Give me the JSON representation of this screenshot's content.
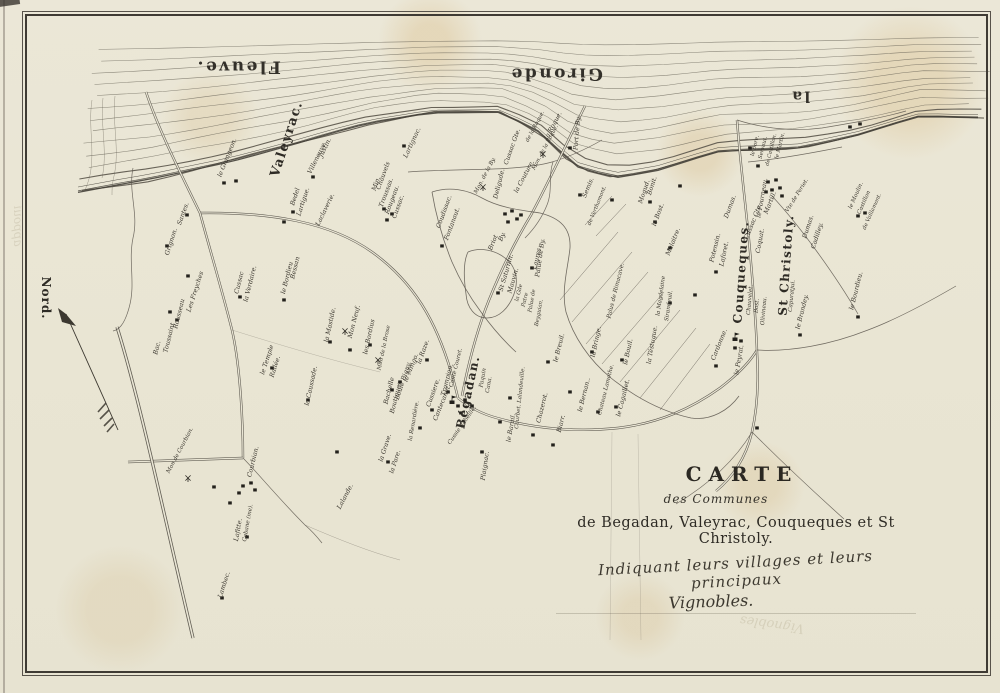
{
  "title_block": {
    "line1": "CARTE",
    "line2": "des Communes",
    "line3": "de Begadan, Valeyrac, Couqueques et St Christoly.",
    "line4": "Indiquant leurs villages et leurs principaux",
    "line5": "Vignobles."
  },
  "compass": {
    "label": "Nord."
  },
  "river_labels": [
    {
      "text": "Fleuve.",
      "x": 238,
      "y": 66,
      "size": 17
    },
    {
      "text": "Gironde",
      "x": 556,
      "y": 73,
      "size": 17
    },
    {
      "text": "la",
      "x": 800,
      "y": 96,
      "size": 15
    }
  ],
  "commune_labels": [
    {
      "text": "Valeyrac.",
      "x": 287,
      "y": 139,
      "r": -72,
      "size": 13
    },
    {
      "text": "Bégadan.",
      "x": 468,
      "y": 392,
      "r": -78,
      "size": 12
    },
    {
      "text": "Couqueques.",
      "x": 741,
      "y": 272,
      "r": -86,
      "size": 12
    },
    {
      "text": "St Christoly.",
      "x": 786,
      "y": 265,
      "r": -86,
      "size": 12
    }
  ],
  "place_labels": [
    [
      "le Grangeon.",
      228,
      158,
      -68
    ],
    [
      "Bedel",
      296,
      197,
      -72
    ],
    [
      "Lartigue.",
      304,
      202,
      -72
    ],
    [
      "Villeneuve.",
      318,
      158,
      -64
    ],
    [
      "Justin.",
      326,
      148,
      -64
    ],
    [
      "Laclaverie.",
      326,
      210,
      -64
    ],
    [
      "Min.",
      377,
      184,
      -70
    ],
    [
      "Chauvels",
      384,
      176,
      -70
    ],
    [
      "Troussas.",
      387,
      193,
      -70
    ],
    [
      "Rougeau.",
      393,
      200,
      -70
    ],
    [
      "Cussac.",
      399,
      207,
      -70
    ],
    [
      "Lartignac.",
      413,
      143,
      -65
    ],
    [
      "Santes.",
      184,
      214,
      -70
    ],
    [
      "Grignon.",
      172,
      242,
      -72
    ],
    [
      "Bac.",
      158,
      348,
      -76
    ],
    [
      "Toussaint",
      170,
      338,
      -76
    ],
    [
      "Rousseau",
      180,
      314,
      -76
    ],
    [
      "Les Freyches",
      196,
      292,
      -72
    ],
    [
      "Cussac",
      240,
      283,
      -76
    ],
    [
      "la Verdaire.",
      251,
      284,
      -76
    ],
    [
      "le Bordieu",
      288,
      278,
      -76
    ],
    [
      "Bessan",
      296,
      268,
      -76
    ],
    [
      "le Temple",
      268,
      360,
      -72
    ],
    [
      "Rallée.",
      276,
      367,
      -72
    ],
    [
      "la Caussade.",
      312,
      386,
      -78
    ],
    [
      "la Mastide.",
      331,
      325,
      -78
    ],
    [
      "Mon Neuf.",
      355,
      322,
      -76
    ],
    [
      "les Bordius",
      370,
      337,
      -78
    ],
    [
      "Mon de la Brose",
      385,
      348,
      -78,
      5.5
    ],
    [
      "Bachelle",
      390,
      391,
      -76
    ],
    [
      "Boutiques.",
      397,
      397,
      -76
    ],
    [
      "Boule Bigny.",
      404,
      381,
      -72
    ],
    [
      "le Mingo.",
      412,
      368,
      -68
    ],
    [
      "la Raze.",
      424,
      352,
      -70
    ],
    [
      "Cussiere.",
      434,
      393,
      -70
    ],
    [
      "Cantecanet.",
      443,
      403,
      -68
    ],
    [
      "la Renardière.",
      415,
      421,
      -80,
      5.6
    ],
    [
      "Trompion.",
      448,
      380,
      -76
    ],
    [
      "Cante Couret.",
      457,
      368,
      -76,
      5.6
    ],
    [
      "Cussie Rabeille.",
      463,
      426,
      -55,
      5.6
    ],
    [
      "la Grave.",
      386,
      448,
      -72
    ],
    [
      "la Pare.",
      396,
      462,
      -72
    ],
    [
      "Mon de Courbian.",
      181,
      451,
      -62,
      5.6
    ],
    [
      "Courbian.",
      254,
      462,
      -76
    ],
    [
      "Lafitte.",
      239,
      530,
      -80
    ],
    [
      "Cabane (me).",
      249,
      523,
      -80,
      5.6
    ],
    [
      "Lambec.",
      225,
      585,
      -72
    ],
    [
      "Lalande.",
      346,
      497,
      -62
    ],
    [
      "Paquin",
      484,
      378,
      -80,
      5.6
    ],
    [
      "Cana.",
      490,
      385,
      -80,
      5.6
    ],
    [
      "Plaignac.",
      486,
      466,
      -82
    ],
    [
      "le Barail.",
      512,
      428,
      -80
    ],
    [
      "Courbet. Lalandeuille.",
      521,
      398,
      -84,
      5.5
    ],
    [
      "Chazerot.",
      543,
      408,
      -76
    ],
    [
      "Biarr.",
      562,
      424,
      -76
    ],
    [
      "le Bernan..",
      585,
      395,
      -76
    ],
    [
      "Chateau Lamothe.",
      607,
      390,
      -76,
      5.6
    ],
    [
      "le Cagaillet.",
      624,
      398,
      -76
    ],
    [
      "le Breuil.",
      560,
      348,
      -76
    ],
    [
      "la Bringe.",
      597,
      342,
      -78
    ],
    [
      "le Bouil.",
      629,
      352,
      -78
    ],
    [
      "Laures.",
      538,
      258,
      -78
    ],
    [
      "Coudissac.",
      445,
      212,
      -70
    ],
    [
      "Fontanaut.",
      453,
      224,
      -70
    ],
    [
      "Mon. de la By.",
      486,
      176,
      -62,
      5.6
    ],
    [
      "Deligude.",
      500,
      184,
      -76
    ],
    [
      "Cussac Gte.",
      513,
      147,
      -70
    ],
    [
      "la Couture.",
      525,
      177,
      -62
    ],
    [
      "Briot",
      494,
      243,
      -68
    ],
    [
      "By.",
      503,
      237,
      -68
    ],
    [
      "St Saturnin.",
      507,
      273,
      -74
    ],
    [
      "Mauvin.",
      514,
      281,
      -74
    ],
    [
      "la Gde",
      520,
      293,
      -76,
      5.4
    ],
    [
      "Patre",
      526,
      300,
      -76,
      5.4
    ],
    [
      "Palue de By.",
      541,
      258,
      -82
    ],
    [
      "Palue de",
      533,
      301,
      -80,
      5.4
    ],
    [
      "Beyguian.",
      540,
      313,
      -80,
      5.4
    ],
    [
      "Port de By.",
      578,
      133,
      -85
    ],
    [
      "de la Roque.",
      536,
      127,
      -62,
      5.4
    ],
    [
      "la Roque.",
      554,
      126,
      -62
    ],
    [
      "Mon. de la Roque.",
      546,
      148,
      -62,
      5.4
    ],
    [
      "Semis.",
      589,
      188,
      -68
    ],
    [
      "de Verthamont.",
      598,
      206,
      -68,
      5.4
    ],
    [
      "Mogud.",
      645,
      192,
      -72
    ],
    [
      "Bonit.",
      653,
      186,
      -72
    ],
    [
      "le Bost.",
      659,
      215,
      -70
    ],
    [
      "Malaitre.",
      674,
      242,
      -68
    ],
    [
      "Palus de Rimacave.",
      617,
      291,
      -76,
      5.8
    ],
    [
      "la Magdelaine",
      662,
      296,
      -82,
      5.6
    ],
    [
      "Sirandeuil.",
      670,
      306,
      -82,
      5.6
    ],
    [
      "la Téstugue.",
      653,
      345,
      -80
    ],
    [
      "Cardonne.",
      720,
      345,
      -68
    ],
    [
      "le Peyrat.",
      740,
      360,
      -80
    ],
    [
      "Potensin.",
      716,
      248,
      -76
    ],
    [
      "Laforet.",
      725,
      254,
      -78
    ],
    [
      "Dumas.",
      731,
      207,
      -70
    ],
    [
      "Chauvelet.",
      751,
      300,
      -85,
      5.6
    ],
    [
      "Bost.",
      758,
      306,
      -85,
      5.6
    ],
    [
      "Olivineau.",
      765,
      311,
      -85,
      5.6
    ],
    [
      "Coquat.",
      761,
      241,
      -80
    ],
    [
      "Cussac Gte.",
      754,
      222,
      -68
    ],
    [
      "le Fourneau.",
      763,
      198,
      -80
    ],
    [
      "Martill.",
      771,
      203,
      -68
    ],
    [
      "Capuratjui.",
      793,
      296,
      -85,
      5.6
    ],
    [
      "Vte de Periet.",
      798,
      196,
      -58,
      5.6
    ],
    [
      "Dumas.",
      809,
      227,
      -72
    ],
    [
      "Cadilley.",
      818,
      236,
      -72
    ],
    [
      "le Brandey.",
      803,
      312,
      -76
    ],
    [
      "le Bourdieu.",
      857,
      291,
      -76
    ],
    [
      "le Moulin.",
      857,
      196,
      -66,
      5.6
    ],
    [
      "Castillon",
      865,
      203,
      -66,
      5.6
    ],
    [
      "de Vaillamont.",
      873,
      212,
      -66,
      5.4
    ],
    [
      "le Bore.",
      756,
      146,
      -76,
      5.4
    ],
    [
      "Servaut.",
      764,
      148,
      -76,
      5.4
    ],
    [
      "de Castillon.",
      772,
      150,
      -76,
      5.2
    ],
    [
      "le Martin.",
      781,
      146,
      -76,
      5.4
    ]
  ],
  "village_markers": [
    [
      224,
      183
    ],
    [
      236,
      181
    ],
    [
      293,
      212
    ],
    [
      284,
      222
    ],
    [
      313,
      177
    ],
    [
      384,
      209
    ],
    [
      392,
      214
    ],
    [
      387,
      220
    ],
    [
      404,
      146
    ],
    [
      187,
      215
    ],
    [
      167,
      246
    ],
    [
      188,
      276
    ],
    [
      170,
      312
    ],
    [
      177,
      320
    ],
    [
      240,
      297
    ],
    [
      284,
      300
    ],
    [
      272,
      368
    ],
    [
      330,
      342
    ],
    [
      308,
      400
    ],
    [
      350,
      350
    ],
    [
      458,
      406
    ],
    [
      465,
      400
    ],
    [
      472,
      406
    ],
    [
      461,
      413
    ],
    [
      500,
      422
    ],
    [
      510,
      398
    ],
    [
      533,
      435
    ],
    [
      553,
      445
    ],
    [
      570,
      392
    ],
    [
      598,
      412
    ],
    [
      616,
      407
    ],
    [
      548,
      362
    ],
    [
      592,
      352
    ],
    [
      622,
      360
    ],
    [
      532,
      268
    ],
    [
      442,
      246
    ],
    [
      505,
      214
    ],
    [
      512,
      211
    ],
    [
      517,
      219
    ],
    [
      508,
      222
    ],
    [
      521,
      215
    ],
    [
      498,
      293
    ],
    [
      570,
      148
    ],
    [
      580,
      195
    ],
    [
      612,
      200
    ],
    [
      650,
      202
    ],
    [
      680,
      186
    ],
    [
      655,
      222
    ],
    [
      670,
      248
    ],
    [
      670,
      303
    ],
    [
      695,
      295
    ],
    [
      716,
      366
    ],
    [
      741,
      341
    ],
    [
      735,
      348
    ],
    [
      716,
      272
    ],
    [
      768,
      182
    ],
    [
      776,
      180
    ],
    [
      772,
      190
    ],
    [
      780,
      188
    ],
    [
      766,
      192
    ],
    [
      782,
      196
    ],
    [
      758,
      166
    ],
    [
      750,
      148
    ],
    [
      858,
      216
    ],
    [
      865,
      213
    ],
    [
      858,
      317
    ],
    [
      800,
      335
    ],
    [
      757,
      428
    ],
    [
      850,
      127
    ],
    [
      860,
      124
    ],
    [
      243,
      486
    ],
    [
      251,
      483
    ],
    [
      239,
      493
    ],
    [
      255,
      490
    ],
    [
      230,
      503
    ],
    [
      214,
      487
    ],
    [
      247,
      537
    ],
    [
      222,
      598
    ],
    [
      337,
      452
    ],
    [
      388,
      462
    ],
    [
      420,
      428
    ],
    [
      432,
      410
    ],
    [
      448,
      392
    ],
    [
      427,
      360
    ],
    [
      392,
      390
    ],
    [
      400,
      382
    ],
    [
      370,
      345
    ],
    [
      482,
      452
    ]
  ],
  "symbols": {
    "windmills": [
      [
        345,
        331
      ],
      [
        378,
        360
      ],
      [
        483,
        187
      ],
      [
        543,
        154
      ],
      [
        188,
        478
      ]
    ],
    "churches": [
      [
        452,
        402
      ],
      [
        735,
        339
      ]
    ]
  },
  "bleedthrough_labels": [
    {
      "text": "appoui",
      "x": 18,
      "y": 226,
      "r": 90,
      "flip": true,
      "size": 12
    },
    {
      "text": "Vignobles",
      "x": 772,
      "y": 624,
      "r": 188,
      "flip": false,
      "size": 13
    }
  ],
  "colors": {
    "paper": "#eae6d5",
    "ink": "#35322b",
    "line": "#5a554c",
    "river_line": "#605b50"
  }
}
